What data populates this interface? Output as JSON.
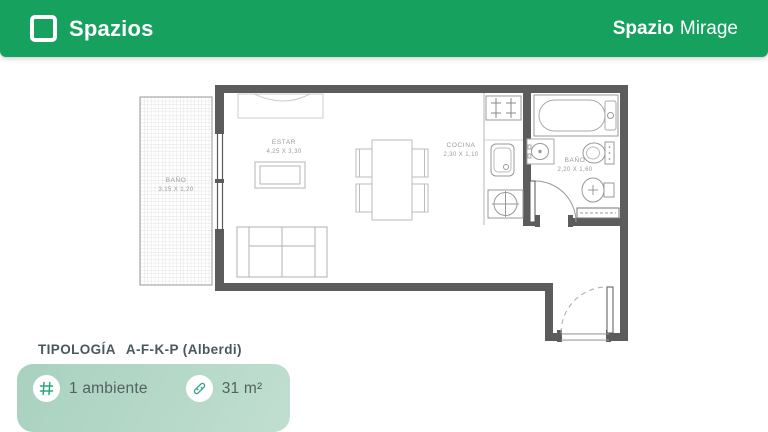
{
  "header": {
    "brand": "Spazios",
    "project": {
      "bold": "Spazio",
      "rest": "Mirage"
    },
    "bg_color": "#16A15F"
  },
  "plan": {
    "wall_color": "#5C5C5C",
    "labels": {
      "balcony_bath": {
        "name": "BAÑO",
        "dims": "3,15 X 1,20"
      },
      "living": {
        "name": "ESTAR",
        "dims": "4,25 X 3,30"
      },
      "kitchen": {
        "name": "COCINA",
        "dims": "2,30 X 1,10"
      },
      "bath": {
        "name": "BAÑO",
        "dims": "2,20 X 1,60"
      }
    }
  },
  "footer": {
    "typology_label": "TIPOLOGÍA",
    "typology_value": "A-F-K-P (Alberdi)",
    "stats": [
      {
        "icon": "grid-icon",
        "value": "1 ambiente"
      },
      {
        "icon": "ruler-icon",
        "value": "31 m²"
      }
    ],
    "accent_color": "#2AA87C",
    "card_color": "#AFD6C5"
  }
}
